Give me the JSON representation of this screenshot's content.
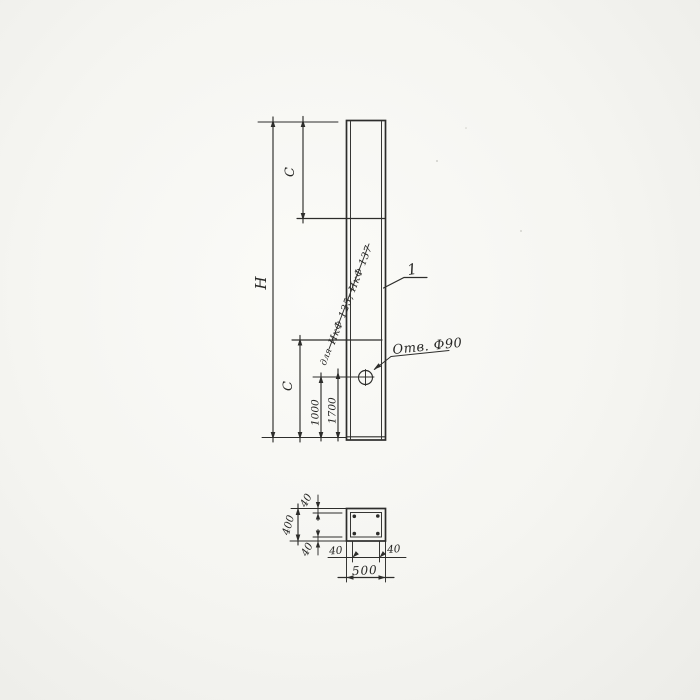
{
  "elevation": {
    "labels": {
      "overall_height": "H",
      "segment_top": "C",
      "segment_bottom": "C",
      "hole_offset_1": "1000",
      "hole_offset_2": "1700"
    },
    "notes": {
      "for": "для",
      "marks": "ИкФ 125; ИкФ 137",
      "hole_callout": "Отв. Ф90",
      "item_number": "1"
    }
  },
  "section": {
    "labels": {
      "width": "500",
      "height": "400",
      "cover_top": "40",
      "cover_bottom": "40",
      "cover_left": "40",
      "cover_right": "40"
    }
  },
  "colors": {
    "paper": "#f5f5f2",
    "ink": "#2d2d2b"
  }
}
